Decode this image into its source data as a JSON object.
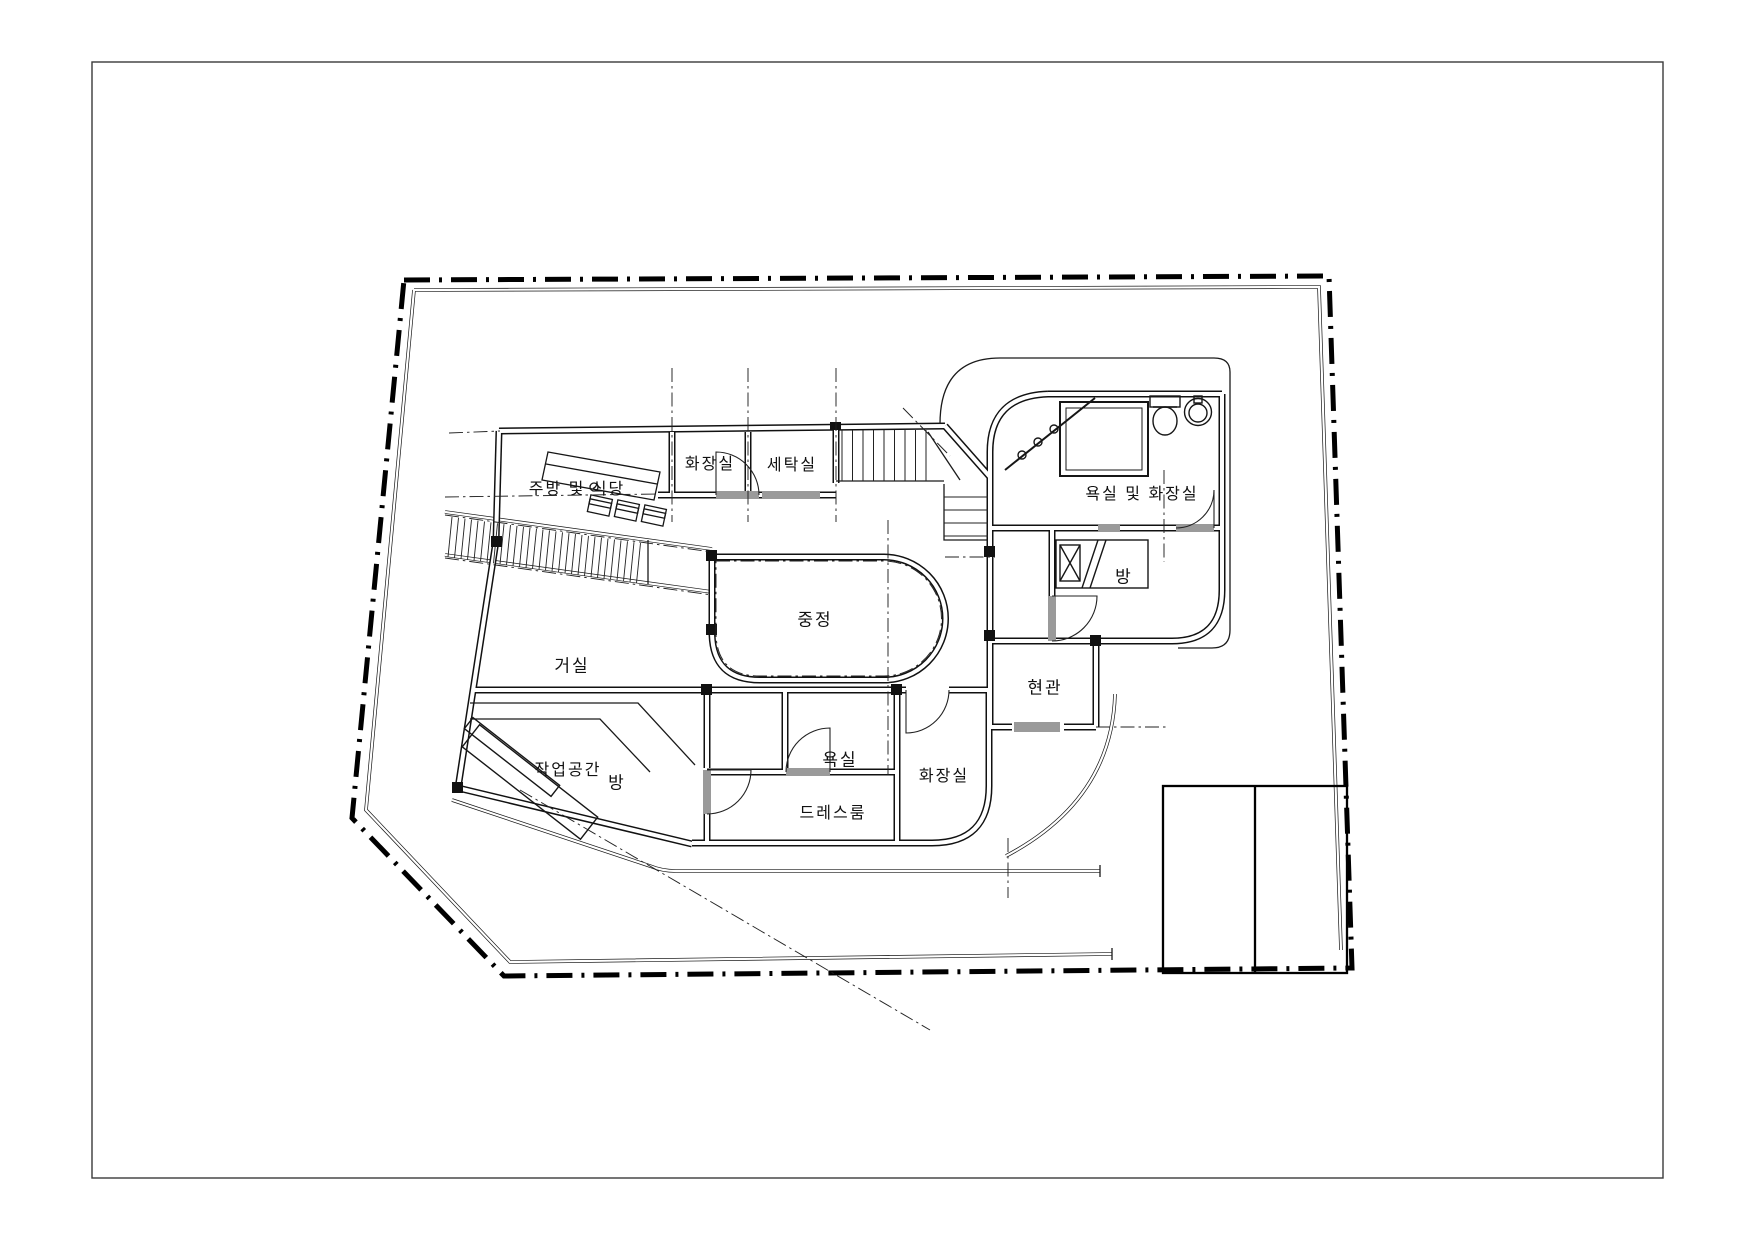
{
  "document": {
    "type": "architectural floor plan drawing",
    "language": "ko",
    "sheet": "white sheet with thin border frame"
  },
  "colors": {
    "paper": "#ffffff",
    "line": "#111111",
    "centerline": "#333333",
    "threshold": "#9a9a9a",
    "frame": "#3a3a3a"
  },
  "rooms": [
    {
      "id": "toilet-upper",
      "label": "화장실",
      "x": 710,
      "y": 462
    },
    {
      "id": "laundry",
      "label": "세탁실",
      "x": 792,
      "y": 463
    },
    {
      "id": "kitchen-dining",
      "label": "주방 및 식당",
      "x": 577,
      "y": 487
    },
    {
      "id": "bath-and-toilet",
      "label": "욕실 및 화장실",
      "x": 1142,
      "y": 492
    },
    {
      "id": "bedroom-right",
      "label": "방",
      "x": 1124,
      "y": 575
    },
    {
      "id": "courtyard",
      "label": "중정",
      "x": 815,
      "y": 618
    },
    {
      "id": "living-room",
      "label": "거실",
      "x": 572,
      "y": 664
    },
    {
      "id": "entrance",
      "label": "현관",
      "x": 1045,
      "y": 686
    },
    {
      "id": "workspace",
      "label": "작업공간",
      "x": 568,
      "y": 768
    },
    {
      "id": "bedroom-lower",
      "label": "방",
      "x": 617,
      "y": 781
    },
    {
      "id": "bathroom-lower",
      "label": "욕실",
      "x": 840,
      "y": 758
    },
    {
      "id": "toilet-lower",
      "label": "화장실",
      "x": 944,
      "y": 774
    },
    {
      "id": "dressing-room",
      "label": "드레스룸",
      "x": 833,
      "y": 811
    }
  ],
  "fixtures": [
    "toilet-icon",
    "round-sink-icon",
    "bathtub-icon",
    "corner-shower-screen-icon",
    "bed-icon",
    "pillow-icon",
    "kitchen-counter-icon",
    "stool-icon",
    "desk-icon",
    "stair-icon",
    "ramp-icon",
    "door-arc-icon",
    "garage-outline"
  ]
}
